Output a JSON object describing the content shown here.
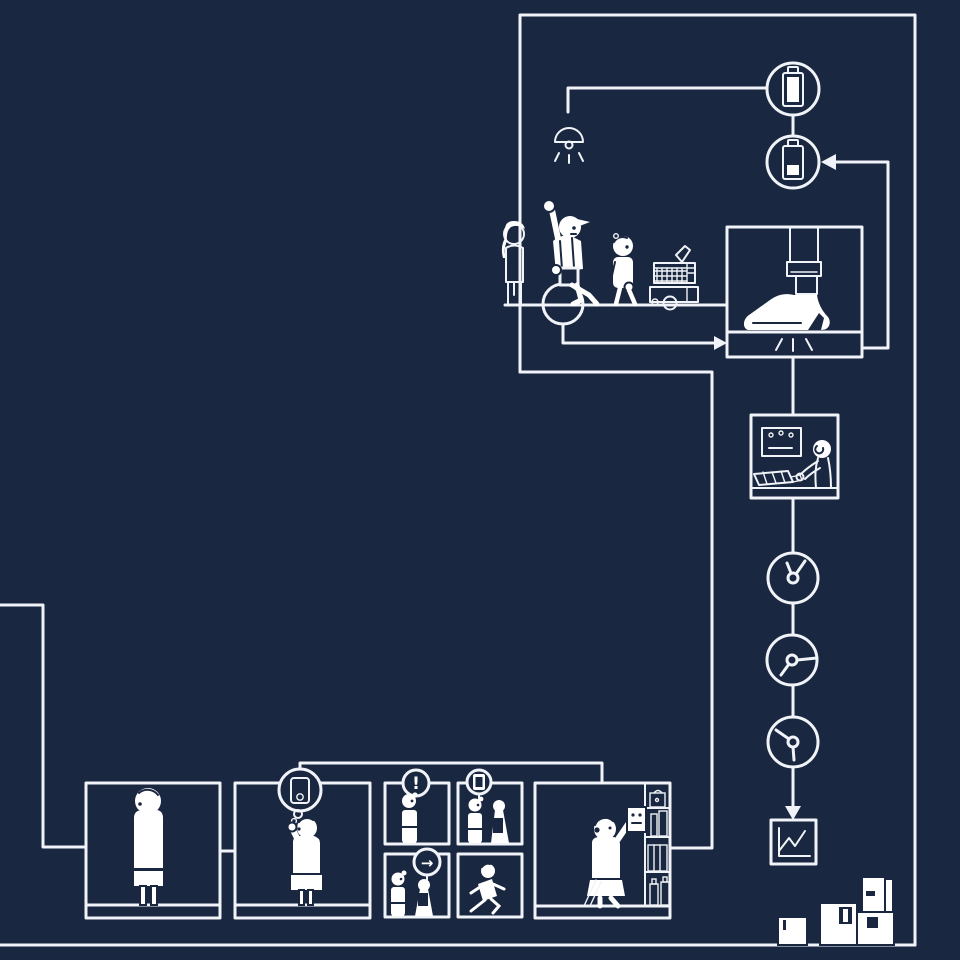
{
  "canvas": {
    "background": "#1a2740",
    "line_color": "#f0f3f7",
    "fill_color": "#ffffff"
  },
  "badges": {
    "exclamation": "!",
    "arrow": "→"
  },
  "illustration": {
    "title": "product-lifecycle-flow-illustration",
    "icons": [
      "battery-full-icon",
      "battery-charging-icon",
      "pendant-lamp-icon",
      "shoe-press-icon",
      "conveyor-scanner-icon",
      "operator-workstation-icon",
      "clock-icon",
      "clock-icon",
      "clock-icon",
      "line-chart-icon",
      "parcel-boxes-icon",
      "delivery-cart-icon",
      "smartphone-icon",
      "alert-icon",
      "arrow-icon"
    ],
    "scenes": [
      "factory-team-scene",
      "shoe-press-scene",
      "quality-operator-scene",
      "waiting-person-scene",
      "phone-support-scene",
      "alert-kiosk-scene",
      "app-kiosk-scene",
      "directions-kiosk-scene",
      "running-person-scene",
      "shelf-shopper-scene"
    ]
  }
}
